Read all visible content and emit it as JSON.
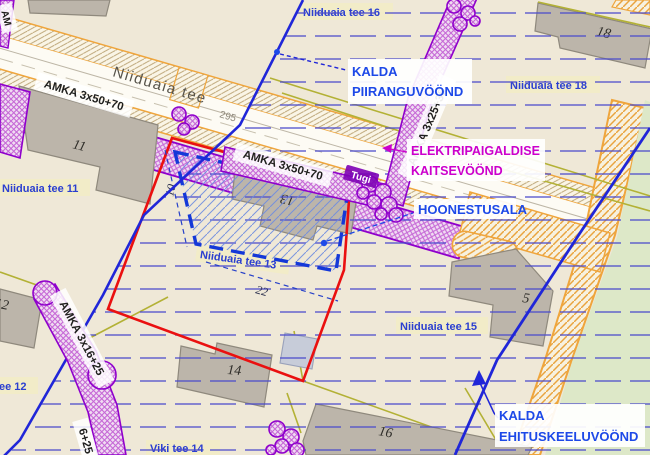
{
  "road": {
    "name": "Niiduaia tee",
    "marker": "295"
  },
  "streets": {
    "s16": "Niiduaia tee 16",
    "s18": "Niiduaia tee 18",
    "s11": "Niiduaia tee 11",
    "s13": "Niiduaia tee 13",
    "s15": "Niiduaia tee 15",
    "s12": "ee 12",
    "viki": "Viki tee 14"
  },
  "zones": {
    "piirang": {
      "l1": "KALDA",
      "l2": "PIIRANGUVÖÖND"
    },
    "kaitse": {
      "l1": "ELEKTRIPAIGALDISE",
      "l2": "KAITSEVÖÖND"
    },
    "hoonestus": {
      "l1": "HOONESTUSALA"
    },
    "keelu": {
      "l1": "KALDA",
      "l2": "EHITUSKEELUVÖÖND"
    }
  },
  "cables": {
    "c50a": "AMKA 3x50+70",
    "c50b": "AMKA 3x50+70",
    "c25": "AMKA 3x25+35",
    "c16": "AMKA 3x16+25",
    "c16b": "6+25",
    "corner": "AM"
  },
  "poles": {
    "tugi": "Tugi"
  },
  "buildings": {
    "b11": "11",
    "b12": "12",
    "b13": "13",
    "b14": "14",
    "b15": "5",
    "b16": "16",
    "b18": "18"
  },
  "dims": {
    "d10": "10",
    "d22": "22"
  },
  "colors": {
    "background": "#efe8d7",
    "boundary_red": "#ea1010",
    "zone_line_blue": "#2026d8",
    "zone_label_blue": "#1d49e8",
    "street_label_blue": "#2b3fd0",
    "cable_purple": "#8f00cc",
    "kaitsevoond_magenta": "#cc00cc",
    "road_orange": "#efa53c",
    "parcel_olive": "#b3b135",
    "building_gray": "#bcb5aa",
    "green_area": "#dde8c8",
    "hoonestusala_blue": "#1438d8"
  }
}
